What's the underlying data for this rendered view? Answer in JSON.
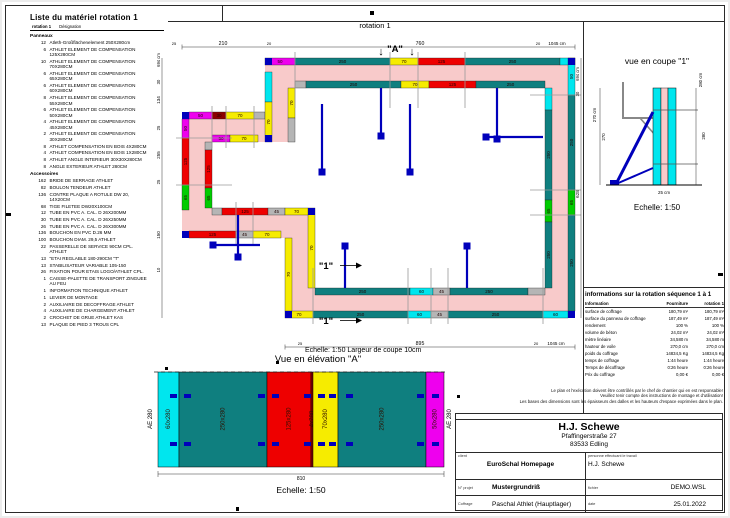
{
  "frame": {
    "rotation_label": "rotation 1"
  },
  "material_list": {
    "title": "Liste du matériel  rotation 1",
    "header_rotation": "rotation 1",
    "header_designation": "Désignation",
    "sections": [
      {
        "name": "Panneaux",
        "items": [
          {
            "qty": "12",
            "name": "Atleth-Großflächenelement 250X280cm"
          },
          {
            "qty": "6",
            "name": "ATHLET ELEMENT DE COMPENSATION 125X280CM"
          },
          {
            "qty": "10",
            "name": "ATHLET ELEMENT DE COMPENSATION 70X280CM"
          },
          {
            "qty": "6",
            "name": "ATHLET ELEMENT DE COMPENSATION 65X280CM"
          },
          {
            "qty": "6",
            "name": "ATHLET ELEMENT DE COMPENSATION 60X280CM"
          },
          {
            "qty": "8",
            "name": "ATHLET ELEMENT DE COMPENSATION 55X280CM"
          },
          {
            "qty": "6",
            "name": "ATHLET ELEMENT DE COMPENSATION 50X280CM"
          },
          {
            "qty": "4",
            "name": "ATHLET ELEMENT DE COMPENSATION 45X280CM"
          },
          {
            "qty": "2",
            "name": "ATHLET ELEMENT DE COMPENSATION 30X280CM"
          },
          {
            "qty": "8",
            "name": "ATHLET COMPENSATION EN BOIS 4X280CM"
          },
          {
            "qty": "4",
            "name": "ATHLET COMPENSATION EN BOIS 1X280CM"
          },
          {
            "qty": "8",
            "name": "ATHLET ANGLE INTERIEUR 30X30X280CM"
          },
          {
            "qty": "8",
            "name": "ANGLE EXTERIEUR ATHLET 280CM"
          }
        ]
      },
      {
        "name": "Accessoires",
        "items": [
          {
            "qty": "162",
            "name": "BRIDE DE SERRAGE ATHLET"
          },
          {
            "qty": "82",
            "name": "BOULON TENDEUR ATHLET"
          },
          {
            "qty": "136",
            "name": "CONTRE PLAQUE A ROTULE DW 20, 14X20CM"
          },
          {
            "qty": "68",
            "name": "TIGE FILETEE DW20X100CM"
          },
          {
            "qty": "12",
            "name": "TUBE EN PVC A. CAL. D 26X200MM"
          },
          {
            "qty": "30",
            "name": "TUBE EN PVC A. CAL. D 26X250MM"
          },
          {
            "qty": "26",
            "name": "TUBE EN PVC A. CAL. D 26X300MM"
          },
          {
            "qty": "136",
            "name": "BOUCHON EN PVC D.26 MM"
          },
          {
            "qty": "100",
            "name": "BOUCHON DIAM. 29,5 ATHLET"
          },
          {
            "qty": "22",
            "name": "PASSERELLE DE SERVICE 90CM CPL. ATHLET"
          },
          {
            "qty": "13",
            "name": "\"ETAI REGLABLE 180-290CM \"T\""
          },
          {
            "qty": "13",
            "name": "STABILISATEUR VARIABLE 105-150"
          },
          {
            "qty": "26",
            "name": "FIXATION POUR ETAIS LOGO/ATHLET CPL."
          },
          {
            "qty": "1",
            "name": "CAISSE-PALETTE DE TRANSPORT ZINGUEE AU FEU"
          },
          {
            "qty": "1",
            "name": "INFORMATION TECHNIQUE ATHLET"
          },
          {
            "qty": "1",
            "name": "LEVIER DE MONTAGE"
          },
          {
            "qty": "2",
            "name": "AUXILIAIRE DE DECOFFRAGE ATHLET"
          },
          {
            "qty": "4",
            "name": "AUXILIAIRE DE CHARGEMENT ATHLET"
          },
          {
            "qty": "2",
            "name": "CROCHET DE GRUE ATHLET KAS"
          },
          {
            "qty": "13",
            "name": "PLAQUE DE PIED 3 TROUS CPL"
          }
        ]
      }
    ]
  },
  "plan": {
    "scale_note": "Echelle: 1:50   Largeur de coupe 10cm",
    "colors": {
      "WALL": "#f8caca",
      "MAG": "#ee00ee",
      "TEA": "#0f7f7f",
      "YEL": "#f6ec00",
      "RED": "#ee0000",
      "CYA": "#00e6ee",
      "GRN": "#00cc00",
      "GRY": "#b5b5b5",
      "DRD": "#8b0000",
      "BLU": "#0000bb",
      "TICK": "#9a9a9a"
    },
    "walls": [
      [
        115,
        44,
        310,
        30
      ],
      [
        395,
        44,
        30,
        260
      ],
      [
        135,
        274,
        290,
        30
      ],
      [
        135,
        194,
        30,
        110
      ],
      [
        32,
        194,
        133,
        30
      ],
      [
        32,
        98,
        30,
        126
      ],
      [
        32,
        98,
        113,
        30
      ],
      [
        115,
        44,
        30,
        84
      ]
    ],
    "panels": [
      [
        115,
        44,
        30,
        7,
        "MAG",
        "50"
      ],
      [
        145,
        44,
        95,
        7,
        "TEA",
        "250"
      ],
      [
        240,
        44,
        28,
        7,
        "YEL",
        "70"
      ],
      [
        268,
        44,
        47,
        7,
        "RED",
        "125"
      ],
      [
        315,
        44,
        95,
        7,
        "TEA",
        "250"
      ],
      [
        410,
        44,
        15,
        7,
        "CYA",
        ""
      ],
      [
        145,
        67,
        11,
        7,
        "GRY",
        ""
      ],
      [
        156,
        67,
        95,
        7,
        "TEA",
        "250"
      ],
      [
        251,
        67,
        28,
        7,
        "YEL",
        "70"
      ],
      [
        279,
        67,
        47,
        7,
        "RED",
        "125"
      ],
      [
        326,
        67,
        69,
        7,
        "TEA",
        "250"
      ],
      [
        418,
        44,
        7,
        37,
        "CYA",
        "50"
      ],
      [
        418,
        81,
        7,
        95,
        "TEA",
        "250"
      ],
      [
        418,
        176,
        7,
        25,
        "GRN",
        "65"
      ],
      [
        418,
        201,
        7,
        96,
        "TEA",
        "250"
      ],
      [
        395,
        74,
        7,
        22,
        "CYA",
        ""
      ],
      [
        395,
        96,
        7,
        90,
        "TEA",
        "250"
      ],
      [
        395,
        186,
        7,
        22,
        "GRN",
        "65"
      ],
      [
        395,
        208,
        7,
        66,
        "TEA",
        "250"
      ],
      [
        135,
        297,
        28,
        7,
        "YEL",
        "70"
      ],
      [
        163,
        297,
        95,
        7,
        "TEA",
        "250"
      ],
      [
        258,
        297,
        23,
        7,
        "CYA",
        "60"
      ],
      [
        281,
        297,
        17,
        7,
        "GRY",
        "45"
      ],
      [
        298,
        297,
        95,
        7,
        "TEA",
        "250"
      ],
      [
        393,
        297,
        25,
        7,
        "CYA",
        "60"
      ],
      [
        165,
        274,
        95,
        7,
        "TEA",
        "250"
      ],
      [
        260,
        274,
        23,
        7,
        "CYA",
        "60"
      ],
      [
        283,
        274,
        17,
        7,
        "GRY",
        "45"
      ],
      [
        300,
        274,
        78,
        7,
        "TEA",
        "250"
      ],
      [
        378,
        274,
        17,
        7,
        "GRY",
        ""
      ],
      [
        135,
        224,
        7,
        73,
        "YEL",
        "70"
      ],
      [
        158,
        194,
        7,
        80,
        "YEL",
        "70"
      ],
      [
        39,
        217,
        47,
        7,
        "RED",
        "125"
      ],
      [
        86,
        217,
        17,
        7,
        "GRY",
        "45"
      ],
      [
        103,
        217,
        28,
        7,
        "YEL",
        "70"
      ],
      [
        62,
        194,
        10,
        7,
        "GRY",
        ""
      ],
      [
        72,
        194,
        46,
        7,
        "RED",
        "125"
      ],
      [
        118,
        194,
        17,
        7,
        "GRY",
        "45"
      ],
      [
        135,
        194,
        23,
        7,
        "YEL",
        "70"
      ],
      [
        32,
        105,
        7,
        19,
        "MAG",
        "50"
      ],
      [
        32,
        124,
        7,
        47,
        "RED",
        "125"
      ],
      [
        32,
        171,
        7,
        25,
        "GRN",
        "65"
      ],
      [
        55,
        128,
        7,
        8,
        "GRY",
        ""
      ],
      [
        55,
        136,
        7,
        38,
        "RED",
        "125"
      ],
      [
        55,
        174,
        7,
        20,
        "GRN",
        "65"
      ],
      [
        39,
        98,
        23,
        7,
        "MAG",
        "50"
      ],
      [
        62,
        98,
        14,
        7,
        "DRD",
        "30"
      ],
      [
        76,
        98,
        28,
        7,
        "YEL",
        "70"
      ],
      [
        104,
        98,
        11,
        7,
        "GRY",
        ""
      ],
      [
        62,
        121,
        18,
        7,
        "MAG",
        "50"
      ],
      [
        80,
        121,
        28,
        7,
        "YEL",
        "70"
      ],
      [
        115,
        58,
        7,
        30,
        "CYA",
        ""
      ],
      [
        115,
        88,
        7,
        40,
        "YEL",
        "70"
      ],
      [
        138,
        74,
        7,
        30,
        "YEL",
        "70"
      ],
      [
        138,
        104,
        7,
        24,
        "GRY",
        ""
      ]
    ],
    "corners": [
      [
        115,
        44
      ],
      [
        418,
        44
      ],
      [
        418,
        297
      ],
      [
        135,
        297
      ],
      [
        32,
        217
      ],
      [
        32,
        98
      ],
      [
        115,
        121
      ],
      [
        158,
        194
      ]
    ],
    "ticks": [
      [
        145,
        38,
        145,
        94
      ],
      [
        240,
        38,
        240,
        94
      ],
      [
        268,
        38,
        268,
        94
      ],
      [
        315,
        38,
        315,
        94
      ],
      [
        380,
        81,
        431,
        81
      ],
      [
        380,
        176,
        431,
        176
      ],
      [
        380,
        201,
        431,
        201
      ],
      [
        163,
        254,
        163,
        310
      ],
      [
        258,
        254,
        258,
        310
      ],
      [
        281,
        254,
        281,
        310
      ],
      [
        298,
        254,
        298,
        310
      ],
      [
        393,
        254,
        393,
        310
      ],
      [
        26,
        124,
        82,
        124
      ],
      [
        26,
        171,
        82,
        171
      ],
      [
        86,
        188,
        86,
        230
      ],
      [
        103,
        188,
        103,
        230
      ],
      [
        62,
        92,
        62,
        134
      ],
      [
        76,
        92,
        76,
        134
      ],
      [
        104,
        92,
        104,
        134
      ]
    ],
    "props": {
      "lines": [
        [
          172,
          90,
          172,
          156
        ],
        [
          260,
          90,
          260,
          156
        ],
        [
          231,
          74,
          231,
          120
        ],
        [
          347,
          74,
          347,
          123
        ],
        [
          338,
          123,
          393,
          123
        ],
        [
          195,
          234,
          195,
          274
        ],
        [
          317,
          234,
          317,
          274
        ],
        [
          65,
          231,
          110,
          231
        ],
        [
          88,
          201,
          88,
          241
        ]
      ],
      "feet": [
        [
          172,
          158
        ],
        [
          260,
          158
        ],
        [
          231,
          122
        ],
        [
          347,
          125
        ],
        [
          336,
          123
        ],
        [
          195,
          232
        ],
        [
          317,
          232
        ],
        [
          63,
          231
        ],
        [
          88,
          243
        ]
      ]
    },
    "dims": {
      "top": {
        "y": 33,
        "x1": 32,
        "x2": 425,
        "labels": [
          [
            "25",
            24,
            4
          ],
          [
            "210",
            73,
            5.2
          ],
          [
            "20",
            119,
            4
          ],
          [
            "760",
            270,
            5.2
          ],
          [
            "20",
            388,
            4
          ],
          [
            "1045 cm",
            407,
            4.5
          ]
        ]
      },
      "bottom": {
        "y": 333,
        "x1": 135,
        "x2": 425,
        "labels": [
          [
            "25",
            150,
            4
          ],
          [
            "895",
            270,
            5.2
          ],
          [
            "20",
            386,
            4
          ],
          [
            "1045 cm",
            406,
            4.5
          ]
        ]
      },
      "left": {
        "x": 12,
        "y1": 44,
        "y2": 304,
        "labels": [
          [
            "694 cm",
            46,
            4.2
          ],
          [
            "30",
            68,
            4.2
          ],
          [
            "134",
            86,
            4.6
          ],
          [
            "25",
            114,
            4.2
          ],
          [
            "255",
            141,
            4.6
          ],
          [
            "25",
            168,
            4.2
          ],
          [
            "150",
            221,
            4.6
          ],
          [
            "10",
            256,
            4.2
          ]
        ]
      },
      "right": {
        "x": 431,
        "y1": 44,
        "y2": 304,
        "labels": [
          [
            "694 cm",
            60,
            4.2
          ],
          [
            "30",
            80,
            4.2
          ],
          [
            "628",
            180,
            4.6
          ]
        ]
      }
    },
    "marker_a": {
      "label": "\"A\"",
      "x": 245,
      "y": 38,
      "arrows": [
        231,
        262
      ]
    },
    "marker_1": {
      "label": "\"1\"",
      "positions": [
        [
          176,
          255
        ],
        [
          176,
          310
        ]
      ]
    }
  },
  "section_view": {
    "title": "vue en coupe \"1\"",
    "dim_left_total": "270 cm",
    "dim_left": "270",
    "dim_right_total": "280 cm",
    "dim_right": "280",
    "dim_bottom": "25 cm",
    "scale": "Echelle: 1:50"
  },
  "elevation": {
    "title": "Vue en élévation \"A\"",
    "panels": [
      {
        "w": 21,
        "c": "CYA",
        "label": "60x280"
      },
      {
        "w": 88,
        "c": "TEA",
        "label": "250x280"
      },
      {
        "w": 44,
        "c": "RED",
        "label": "125x280"
      },
      {
        "w": 2,
        "c": "DRD",
        "label": "4x280"
      },
      {
        "w": 25,
        "c": "YEL",
        "label": "70x280"
      },
      {
        "w": 88,
        "c": "TEA",
        "label": "250x280"
      },
      {
        "w": 18,
        "c": "MAG",
        "label": "50x280"
      }
    ],
    "ae_left": "AE 280",
    "ae_right": "AE 280",
    "total_width": "810",
    "scale": "Echelle: 1:50"
  },
  "info_table": {
    "title": "informations sur la rotation  séquence 1 à 1",
    "headers": [
      "Information",
      "Fourniture",
      "rotation 1"
    ],
    "rows": [
      [
        "surface de coffrage",
        "180,79 m²",
        "180,79 m²"
      ],
      [
        "surface du panneau de coffrage",
        "187,49 m²",
        "187,49 m²"
      ],
      [
        "rendement",
        "100 %",
        "100 %"
      ],
      [
        "volume de béton",
        "24,02 m³",
        "24,02 m³"
      ],
      [
        "mètre linéaire",
        "34,580 m",
        "34,580 m"
      ],
      [
        "hauteur de voile",
        "270,0 cm",
        "270,0 cm"
      ],
      [
        "poids du coffrage",
        "14834,5 Kg",
        "14834,5 Kg"
      ],
      [
        "temps de coffrage",
        "1:44 heure",
        "1:44 heure"
      ],
      [
        "Temps de décoffrage",
        "0:26 heure",
        "0:26 heure"
      ],
      [
        "Prix du coffrage",
        "0,00 €",
        "0,00 €"
      ]
    ]
  },
  "disclaimer": [
    "Le plan et l'exécution doivent être contrôlés par le chef de chantier qui en est responsable!",
    "Veuillez tenir compte des instructions de montage et d'utilisation!",
    "Les bases des dimensions sont les épaisseurs des dalles et les hauteurs d'espace exprimées dans le plan."
  ],
  "title_block": {
    "company": "H.J. Schewe",
    "street": "Pfaffingerstraße 27",
    "city": "83533 Edling",
    "client_label": "client",
    "client_value": "EuroSchal Homepage",
    "worker_label": "personne effectuant le travail",
    "worker_value": "H.J. Schewe",
    "project_label": "N° projet",
    "project_value": "Mustergrundriß",
    "file_label": "fichier",
    "file_value": "DEMO.WSL",
    "coffrage_label": "Coffrage",
    "coffrage_value": "Paschal Athlet (Hauptlager)",
    "date_label": "date",
    "date_value": "25.01.2022"
  }
}
